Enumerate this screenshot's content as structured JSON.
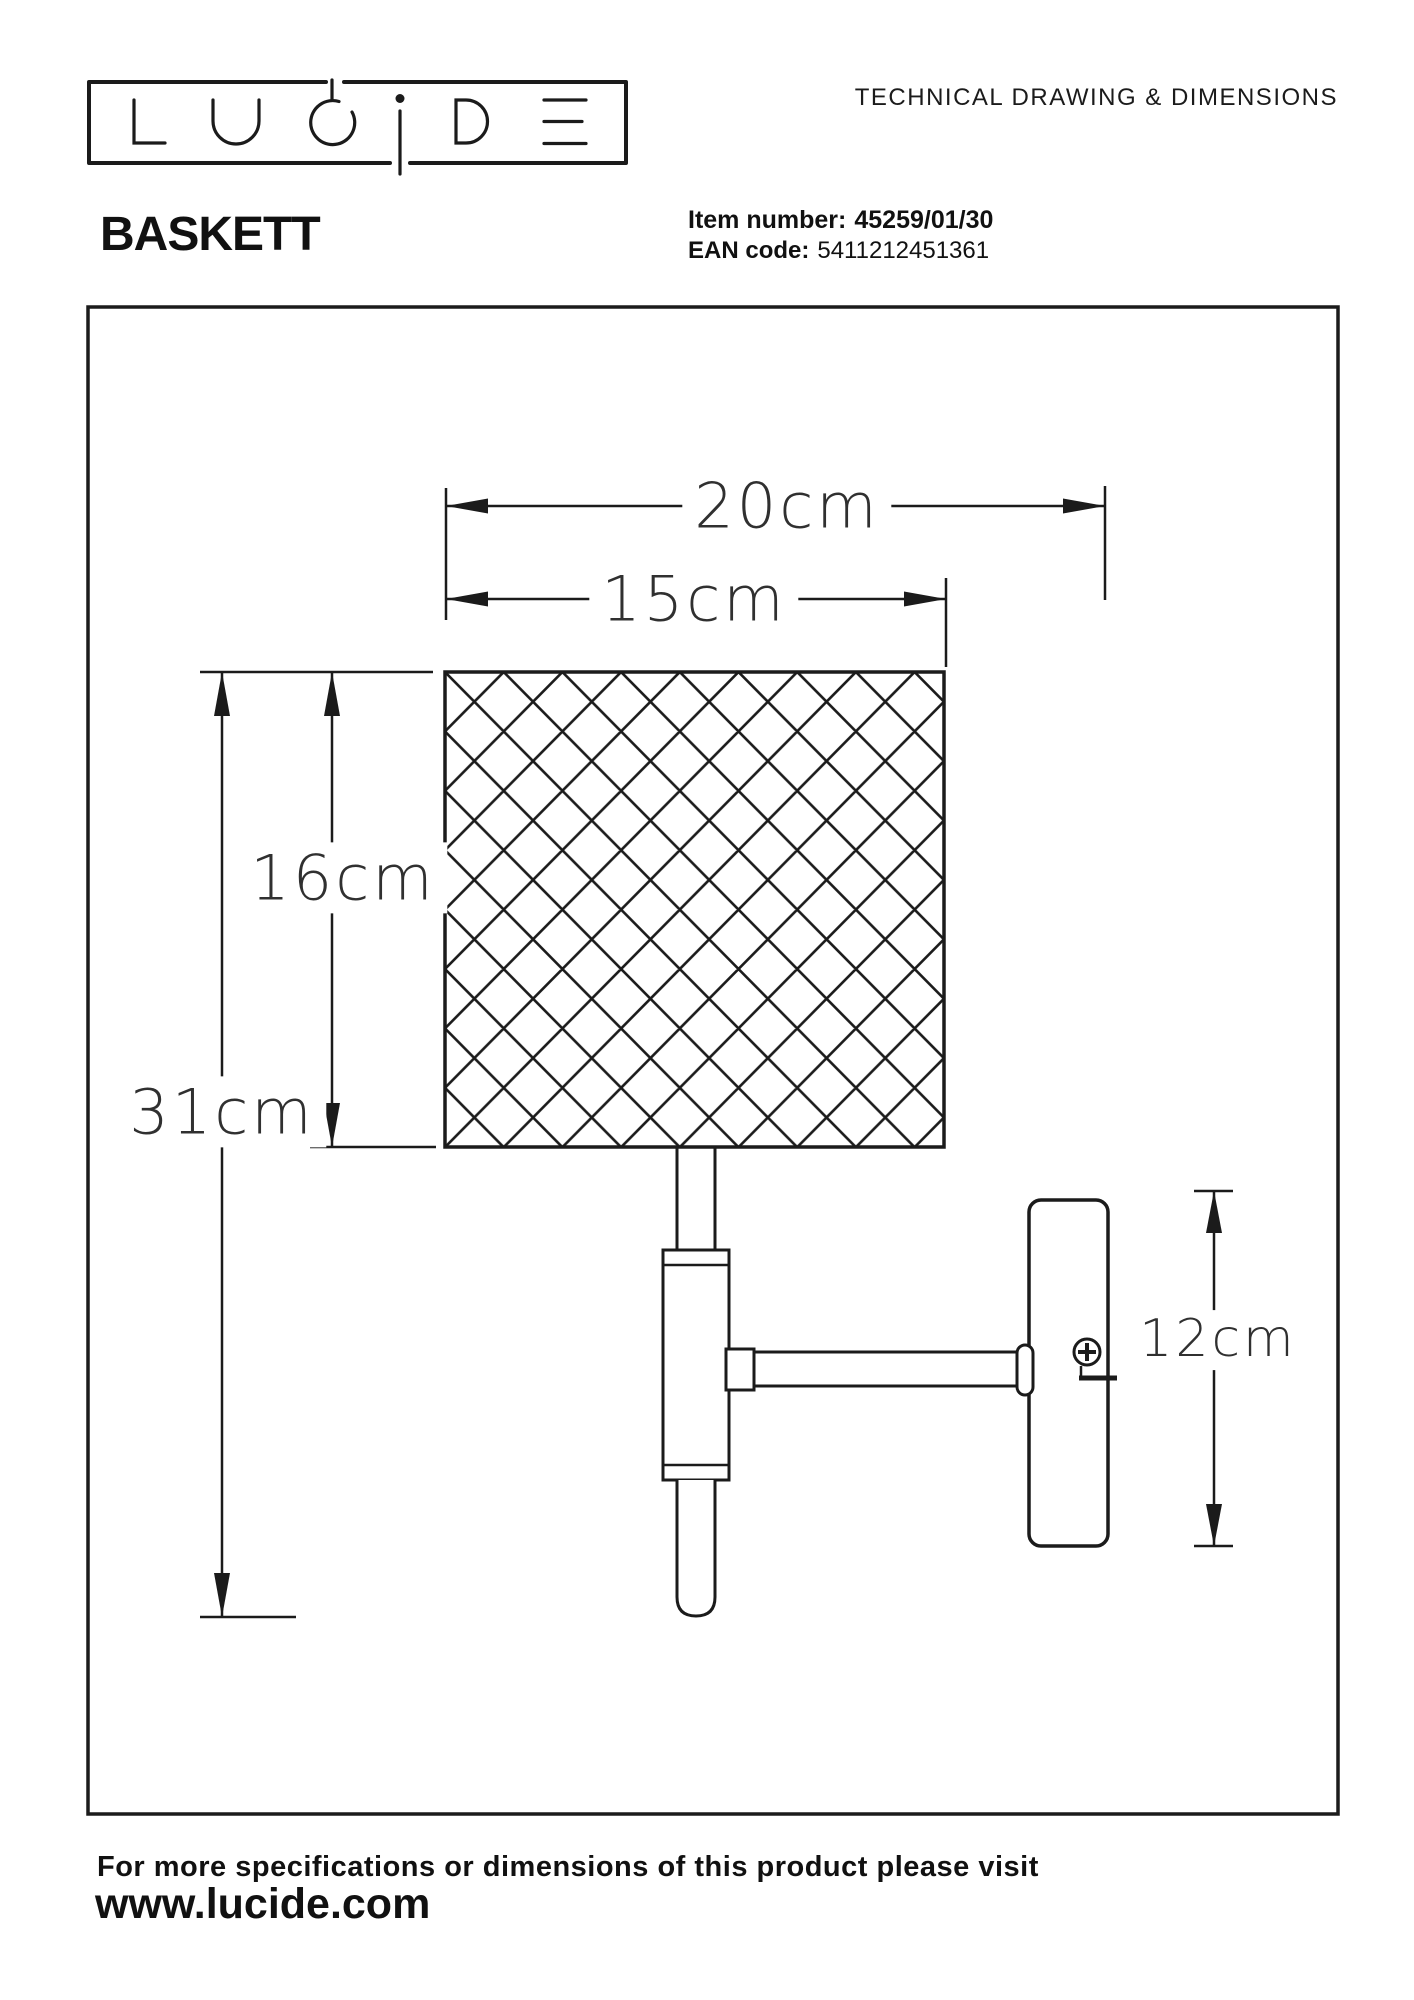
{
  "brand": {
    "name": "LUCIDE"
  },
  "header": {
    "title": "TECHNICAL DRAWING & DIMENSIONS"
  },
  "product": {
    "name": "BASKETT",
    "item_number_label": "Item number:",
    "item_number": "45259/01/30",
    "ean_label": "EAN code:",
    "ean_code": "5411212451361"
  },
  "drawing": {
    "type": "wall-lamp technical drawing",
    "dimensions": {
      "total_depth": "20cm",
      "shade_width": "15cm",
      "shade_height": "16cm",
      "total_height": "31cm",
      "wall_plate_height": "12cm"
    }
  },
  "footer": {
    "note": "For more specifications or dimensions of this product please visit",
    "website": "www.lucide.com"
  },
  "colors": {
    "ink": "#1b1b1b",
    "background": "#ffffff"
  }
}
